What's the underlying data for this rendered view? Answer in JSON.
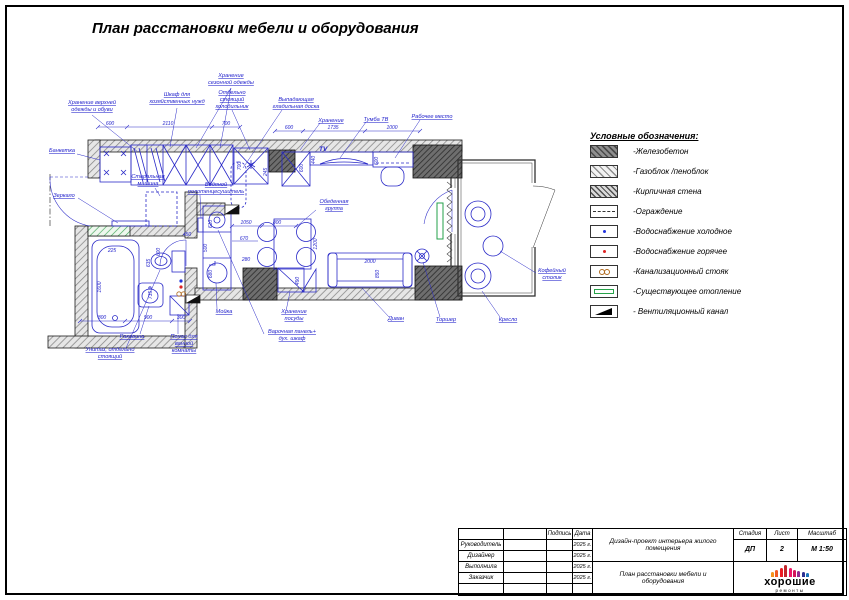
{
  "title": "План расстановки мебели и оборудования",
  "legend": {
    "title": "Условные обозначения:",
    "items": [
      {
        "icon": "concrete-hatch",
        "label": "-Железобетон"
      },
      {
        "icon": "gasblock-hatch",
        "label": "-Газоблок /пеноблок"
      },
      {
        "icon": "brick-hatch",
        "label": "-Кирпичная стена"
      },
      {
        "icon": "fence-line",
        "label": "-Ограждение"
      },
      {
        "icon": "cold-water-dot",
        "label": "-Водоснабжение холодное"
      },
      {
        "icon": "hot-water-dot",
        "label": "-Водоснабжение горячее"
      },
      {
        "icon": "sewer-riser",
        "label": "-Канализационный стояк"
      },
      {
        "icon": "heating-radiator",
        "label": "-Существующее отопление"
      },
      {
        "icon": "vent-channel",
        "label": "- Вентиляционный канал"
      }
    ]
  },
  "titleblock": {
    "col_podpis": "Подпись",
    "col_data": "Дата",
    "col_stage": "Стадия",
    "col_sheet": "Лист",
    "col_scale": "Масштаб",
    "rows": [
      "Руководитель",
      "Дизайнер",
      "Выполнила",
      "Заказчик"
    ],
    "date": "2025 г.",
    "project": "Дизайн-проект интерьера жилого помещения",
    "document": "План расстановки мебели и оборудования",
    "stage": "ДП",
    "sheet": "2",
    "scale": "М 1:50",
    "logo": {
      "top": "хорошие",
      "bottom": "ремонты",
      "figures": [
        {
          "c": "#f7941d",
          "h": 5
        },
        {
          "c": "#f15a24",
          "h": 7
        },
        {
          "c": "#ed1c24",
          "h": 9
        },
        {
          "c": "#c1272d",
          "h": 12
        },
        {
          "c": "#ed1566",
          "h": 9
        },
        {
          "c": "#d4145a",
          "h": 7
        },
        {
          "c": "#93278f",
          "h": 6
        },
        {
          "c": "#2e3192",
          "h": 5
        },
        {
          "c": "#1b75bc",
          "h": 4
        }
      ]
    }
  },
  "plan": {
    "labels": [
      {
        "lines": [
          "Банкетка"
        ],
        "x": 62,
        "y": 152,
        "leads": [
          [
            [
              77,
              154
            ],
            [
              100,
              160
            ]
          ]
        ]
      },
      {
        "lines": [
          "Хранение верхней",
          "одежды и обуви"
        ],
        "x": 92,
        "y": 104,
        "leads": [
          [
            [
              92,
              115
            ],
            [
              138,
              152
            ]
          ]
        ]
      },
      {
        "lines": [
          "Шкаф для",
          "хозяйственных нужд"
        ],
        "x": 177,
        "y": 96,
        "leads": [
          [
            [
              177,
              108
            ],
            [
              170,
              147
            ]
          ]
        ]
      },
      {
        "lines": [
          "Хранение",
          "сезонной одежды"
        ],
        "x": 231,
        "y": 77,
        "leads": [
          [
            [
              231,
              88
            ],
            [
              196,
              148
            ]
          ],
          [
            [
              231,
              88
            ],
            [
              220,
              148
            ]
          ]
        ]
      },
      {
        "lines": [
          "Отдельно",
          "стоящий",
          "холодильник"
        ],
        "x": 232,
        "y": 94,
        "leads": [
          [
            [
              232,
              110
            ],
            [
              250,
              150
            ]
          ]
        ]
      },
      {
        "lines": [
          "Выпадающая",
          "гладильная доска"
        ],
        "x": 296,
        "y": 101,
        "leads": [
          [
            [
              282,
              110
            ],
            [
              243,
              168
            ]
          ]
        ]
      },
      {
        "lines": [
          "Хранение"
        ],
        "x": 331,
        "y": 122,
        "leads": [
          [
            [
              320,
              123
            ],
            [
              300,
              150
            ]
          ]
        ]
      },
      {
        "lines": [
          "Тумба ТВ"
        ],
        "x": 376,
        "y": 121,
        "leads": [
          [
            [
              366,
              122
            ],
            [
              340,
              158
            ]
          ]
        ]
      },
      {
        "lines": [
          "Рабочее место"
        ],
        "x": 432,
        "y": 118,
        "leads": [
          [
            [
              420,
              120
            ],
            [
              395,
              158
            ]
          ]
        ]
      },
      {
        "lines": [
          "Зеркало"
        ],
        "x": 64,
        "y": 197,
        "leads": [
          [
            [
              78,
              198
            ],
            [
              118,
              223
            ]
          ]
        ]
      },
      {
        "lines": [
          "Стиральная",
          "машина"
        ],
        "x": 148,
        "y": 178,
        "leads": [
          [
            [
              155,
              188
            ],
            [
              160,
              196
            ]
          ]
        ]
      },
      {
        "lines": [
          "Водяной",
          "полотенцесушитель"
        ],
        "x": 216,
        "y": 186,
        "leads": [
          [
            [
              200,
              195
            ],
            [
              201,
              218
            ]
          ]
        ]
      },
      {
        "lines": [
          "Обеденная",
          "группа"
        ],
        "x": 334,
        "y": 203,
        "leads": [
          [
            [
              316,
              210
            ],
            [
              296,
              227
            ]
          ]
        ]
      },
      {
        "lines": [
          "TV"
        ],
        "x": 319,
        "y": 151,
        "anchor": "start",
        "plain": true
      },
      {
        "lines": [
          "Диван"
        ],
        "x": 396,
        "y": 320,
        "leads": [
          [
            [
              389,
              317
            ],
            [
              362,
              288
            ]
          ]
        ]
      },
      {
        "lines": [
          "Торшер"
        ],
        "x": 446,
        "y": 321,
        "leads": [
          [
            [
              440,
              317
            ],
            [
              423,
              262
            ]
          ]
        ]
      },
      {
        "lines": [
          "Кресло"
        ],
        "x": 508,
        "y": 321,
        "leads": [
          [
            [
              500,
              317
            ],
            [
              482,
              291
            ]
          ]
        ]
      },
      {
        "lines": [
          "Кофейный",
          "столик"
        ],
        "x": 552,
        "y": 272,
        "leads": [
          [
            [
              536,
              273
            ],
            [
              500,
              251
            ]
          ]
        ]
      },
      {
        "lines": [
          "Мойка"
        ],
        "x": 224,
        "y": 313,
        "leads": [
          [
            [
              217,
              309
            ],
            [
              216,
              283
            ]
          ]
        ]
      },
      {
        "lines": [
          "Раковина"
        ],
        "x": 132,
        "y": 338,
        "leads": [
          [
            [
              140,
              334
            ],
            [
              149,
              306
            ]
          ]
        ]
      },
      {
        "lines": [
          "Унитаз, отдельно",
          "стоящий"
        ],
        "x": 110,
        "y": 351,
        "leads": [
          [
            [
              126,
              348
            ],
            [
              160,
              270
            ]
          ]
        ]
      },
      {
        "lines": [
          "Пенал для",
          "ванной",
          "комнаты"
        ],
        "x": 184,
        "y": 338,
        "leads": [
          [
            [
              178,
              334
            ],
            [
              178,
              314
            ]
          ]
        ]
      },
      {
        "lines": [
          "Хранение",
          "посуды"
        ],
        "x": 294,
        "y": 313,
        "leads": [
          [
            [
              286,
              311
            ],
            [
              290,
              292
            ]
          ]
        ]
      },
      {
        "lines": [
          "Варочная панель+",
          "дух. шкаф"
        ],
        "x": 292,
        "y": 333,
        "leads": [
          [
            [
              264,
              334
            ],
            [
              218,
              230
            ]
          ]
        ]
      }
    ],
    "dims": [
      {
        "v": "600",
        "x": 110,
        "y": 125
      },
      {
        "v": "2110",
        "x": 168,
        "y": 125
      },
      {
        "v": "700",
        "x": 226,
        "y": 125
      },
      {
        "v": "600",
        "x": 289,
        "y": 129
      },
      {
        "v": "1735",
        "x": 333,
        "y": 129
      },
      {
        "v": "1000",
        "x": 392,
        "y": 129
      },
      {
        "v": "800",
        "x": 102,
        "y": 319
      },
      {
        "v": "900",
        "x": 148,
        "y": 319
      },
      {
        "v": "300",
        "x": 181,
        "y": 319
      },
      {
        "v": "1600",
        "x": 101,
        "y": 287,
        "r": -90
      },
      {
        "v": "225",
        "x": 112,
        "y": 252
      },
      {
        "v": "600",
        "x": 160,
        "y": 252,
        "r": -90
      },
      {
        "v": "635",
        "x": 150,
        "y": 263,
        "r": -90
      },
      {
        "v": "450",
        "x": 187,
        "y": 236
      },
      {
        "v": "735",
        "x": 152,
        "y": 295,
        "r": -90
      },
      {
        "v": "610",
        "x": 212,
        "y": 224,
        "r": -90
      },
      {
        "v": "500",
        "x": 207,
        "y": 248,
        "r": -90
      },
      {
        "v": "680",
        "x": 212,
        "y": 274,
        "r": -90
      },
      {
        "v": "1050",
        "x": 246,
        "y": 224
      },
      {
        "v": "800",
        "x": 277,
        "y": 224
      },
      {
        "v": "670",
        "x": 244,
        "y": 240
      },
      {
        "v": "280",
        "x": 246,
        "y": 261
      },
      {
        "v": "245",
        "x": 267,
        "y": 172,
        "r": -90
      },
      {
        "v": "1200",
        "x": 317,
        "y": 244,
        "r": -90
      },
      {
        "v": "490",
        "x": 299,
        "y": 281,
        "r": -90
      },
      {
        "v": "700",
        "x": 241,
        "y": 166,
        "r": -90
      },
      {
        "v": "440",
        "x": 315,
        "y": 160,
        "r": -90
      },
      {
        "v": "600",
        "x": 303,
        "y": 168,
        "r": -90
      },
      {
        "v": "600",
        "x": 378,
        "y": 161,
        "r": -90
      },
      {
        "v": "2000",
        "x": 370,
        "y": 263
      },
      {
        "v": "850",
        "x": 379,
        "y": 274,
        "r": -90
      }
    ]
  }
}
